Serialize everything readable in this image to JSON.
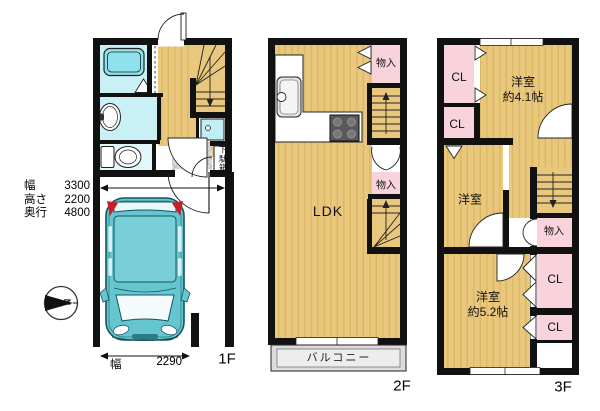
{
  "colors": {
    "wall": "#111111",
    "wood_floor": "#E9C87D",
    "wood_stripe": "#D9B763",
    "closet_pink": "#F8D3DB",
    "bath_cyan": "#C9F1F5",
    "tub_cyan": "#8FE2EC",
    "entry_tile_grey": "#DCDCDC",
    "car_teal": "#66C6D0",
    "tail_light_red": "#C8202A"
  },
  "f1": {
    "floor_label": "1F",
    "shoe_cabinet": "下駄箱",
    "compass_north": "N",
    "garage_dims": [
      {
        "label": "幅",
        "value": "3300"
      },
      {
        "label": "高さ",
        "value": "2200"
      },
      {
        "label": "奥行",
        "value": "4800"
      }
    ],
    "garage_width": {
      "label": "幅",
      "value": "2290"
    }
  },
  "f2": {
    "floor_label": "2F",
    "ldk_label": "LDK",
    "storage_top": "物入",
    "storage_mid": "物入",
    "balcony_label": "バルコニー"
  },
  "f3": {
    "floor_label": "3F",
    "closet_1": "CL",
    "closet_2": "CL",
    "closet_3": "CL",
    "closet_4": "CL",
    "storage": "物入",
    "room_41": [
      "洋室",
      "約4.1帖"
    ],
    "room_mid": "洋室",
    "room_52": [
      "洋室",
      "約5.2帖"
    ]
  }
}
